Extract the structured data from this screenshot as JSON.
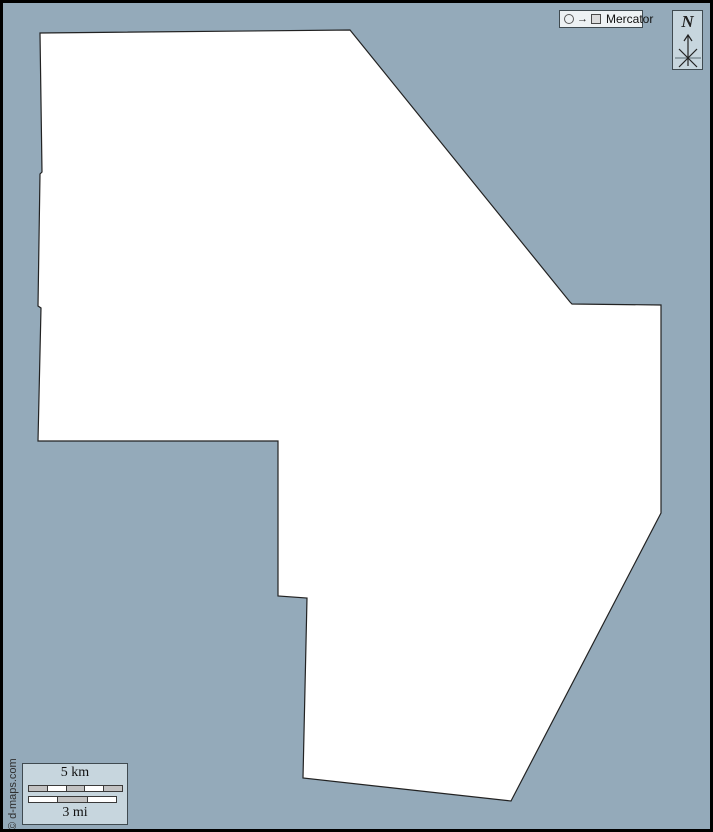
{
  "canvas": {
    "width": 713,
    "height": 832,
    "background": "#94aaba",
    "frame_color": "#000000"
  },
  "map": {
    "fill": "#ffffff",
    "stroke": "#222222",
    "outline_points": [
      [
        40,
        33
      ],
      [
        350,
        30
      ],
      [
        570,
        302
      ],
      [
        572,
        304
      ],
      [
        661,
        305
      ],
      [
        661,
        513
      ],
      [
        511,
        801
      ],
      [
        303,
        778
      ],
      [
        307,
        598
      ],
      [
        278,
        596
      ],
      [
        278,
        441
      ],
      [
        38,
        441
      ],
      [
        41,
        308
      ],
      [
        38,
        306
      ],
      [
        40,
        174
      ],
      [
        42,
        172
      ]
    ]
  },
  "projection_badge": {
    "label": "Mercator",
    "arrow_glyph": "→"
  },
  "compass": {
    "label": "N"
  },
  "scale_bar": {
    "km_label": "5 km",
    "mi_label": "3 mi",
    "km_segments": [
      "#c2c2c2",
      "#ffffff",
      "#c2c2c2",
      "#ffffff",
      "#c2c2c2"
    ],
    "mi_segments": [
      "#ffffff",
      "#c2c2c2",
      "#ffffff"
    ]
  },
  "copyright": {
    "text": "© d-maps.com"
  },
  "colors": {
    "panel_fill": "#c7d6de",
    "badge_fill": "#eef2f4",
    "segment_gray": "#c2c2c2",
    "water": "#94aaba",
    "land": "#ffffff"
  }
}
